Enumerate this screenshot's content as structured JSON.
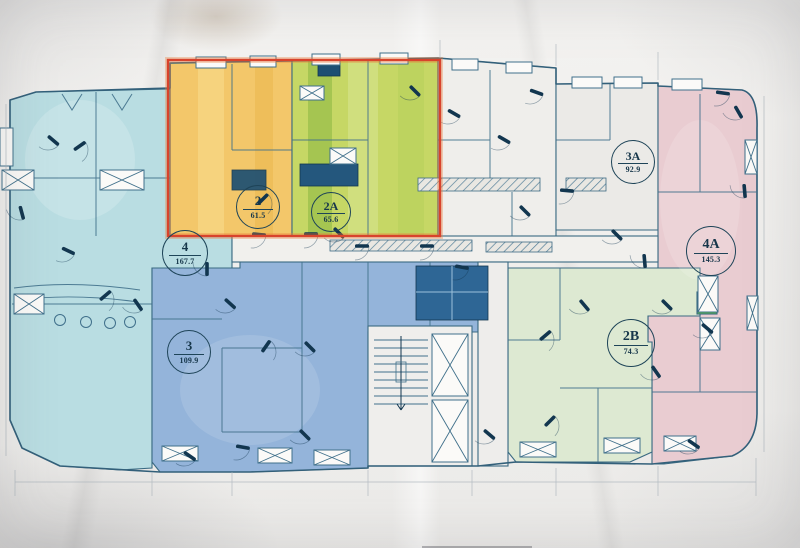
{
  "sheet": {
    "kind_label": "apartment floor plan photo",
    "units": [
      {
        "id": "2",
        "area": "61.5",
        "fill": "#f3c76a"
      },
      {
        "id": "2A",
        "area": "65.6",
        "fill": "#c6d765"
      },
      {
        "id": "2B",
        "area": "74.3",
        "fill": "#dde9d2"
      },
      {
        "id": "3",
        "area": "109.9",
        "fill": "#94b4da"
      },
      {
        "id": "3A",
        "area": "92.9",
        "fill": "#ebeae7"
      },
      {
        "id": "4",
        "area": "167.7",
        "fill": "#b9dde2"
      },
      {
        "id": "4A",
        "area": "145.3",
        "fill": "#e9ccd1"
      }
    ],
    "palette": {
      "line": "#3e6b84",
      "dark_ink": "#12364f",
      "highlight_red": "#d8432c",
      "small_room_green": "#5cb84d",
      "center_unit": "#efeeeb",
      "corridor": "#f1f0ed",
      "stair_core": "#efeeec",
      "table_edge": "#26262e"
    }
  }
}
